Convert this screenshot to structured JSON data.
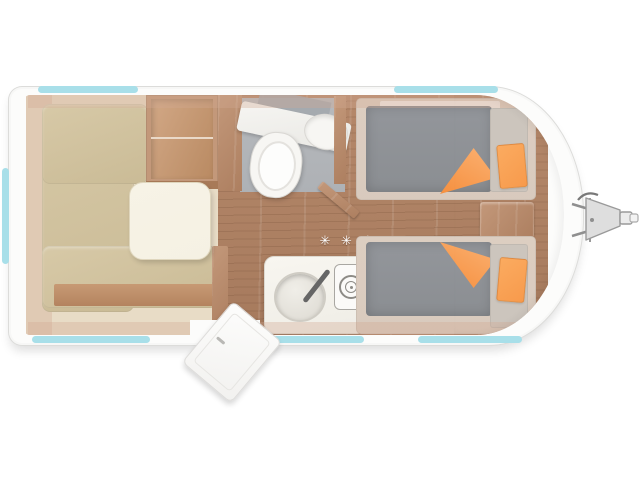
{
  "labels": {
    "heater_symbol": "✳ ✳ ✳"
  },
  "colors": {
    "shell_white": "#fcfcfb",
    "shell_outline": "#dcdcda",
    "window_teal": "#a8dfe9",
    "wood_floor": "#b5886a",
    "wood_floor_dark": "#a67a5d",
    "wood_cabinet": "#c3987a",
    "wood_cabinet_dark": "#ad7f60",
    "cushion_beige": "#d7c9a7",
    "cushion_beige_dark": "#cabb96",
    "table_cream": "#f5f1e3",
    "mattress_gray": "#8b8e92",
    "bed_frame": "#d9d1c7",
    "headboard_gray": "#ccc5bd",
    "accent_orange": "#f79a4c",
    "bath_floor_gray": "#b6b9bd",
    "fixture_white": "#f7f6f3",
    "wall_tint": "rgba(210,169,146,0.35)",
    "hitch_gray": "#dedede",
    "hitch_outline": "#9a9a9a"
  }
}
